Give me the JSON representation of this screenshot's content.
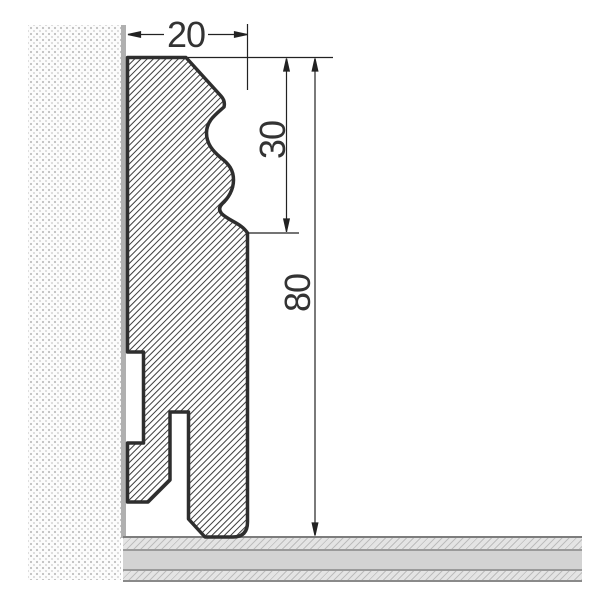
{
  "drawing": {
    "kind": "skirting-board cross-section",
    "dimensions": {
      "width_mm": {
        "label": "20"
      },
      "profile_height_mm": {
        "label": "30"
      },
      "total_height_mm": {
        "label": "80"
      }
    },
    "colors": {
      "outline": "#2e2e2e",
      "dimension_lines": "#222222",
      "hatch_lines": "#3c3c3c",
      "wall_dots": "#c2c2c2",
      "wall_surface": "#b0b0b0",
      "floor_solid_gray": "#d3d3d3",
      "floor_hatch_gray": "#e4e4e4"
    }
  }
}
